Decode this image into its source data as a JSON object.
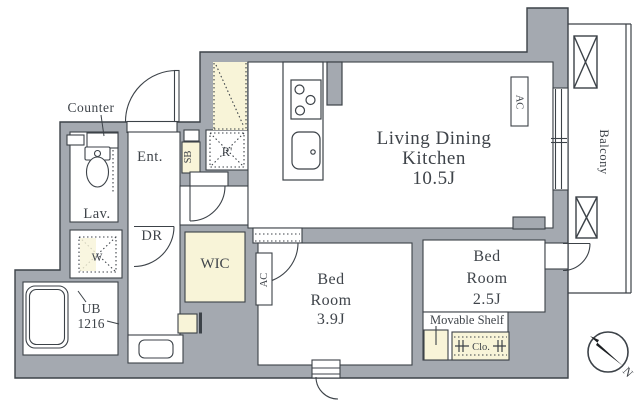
{
  "plan": {
    "title_hint": "apartment floor plan",
    "rooms": {
      "ldk": {
        "lines": [
          "Living Dining",
          "Kitchen",
          "10.5J"
        ]
      },
      "bedroom_39": {
        "lines": [
          "Bed",
          "Room",
          "3.9J"
        ]
      },
      "bedroom_25": {
        "lines": [
          "Bed",
          "Room",
          "2.5J"
        ]
      },
      "wic": {
        "label": "WIC"
      },
      "dressing_room": {
        "label": "DR"
      },
      "entrance": {
        "label": "Ent."
      },
      "lavatory": {
        "label": "Lav."
      },
      "unit_bath": {
        "lines": [
          "UB",
          "1216"
        ]
      },
      "balcony": {
        "label": "Balcony"
      }
    },
    "fixtures": {
      "counter": "Counter",
      "shoe_box": "SB",
      "refrigerator": "R'",
      "washing_machine": "W",
      "ac_living": "AC",
      "ac_bedroom": "AC",
      "movable_shelf": "Movable Shelf",
      "closet": "Clo."
    },
    "compass": {
      "north": "N"
    },
    "colors": {
      "wall": "#a4a9b0",
      "line": "#3c4248",
      "accent_cream": "#f8f4d8",
      "text": "#3f444a"
    }
  }
}
